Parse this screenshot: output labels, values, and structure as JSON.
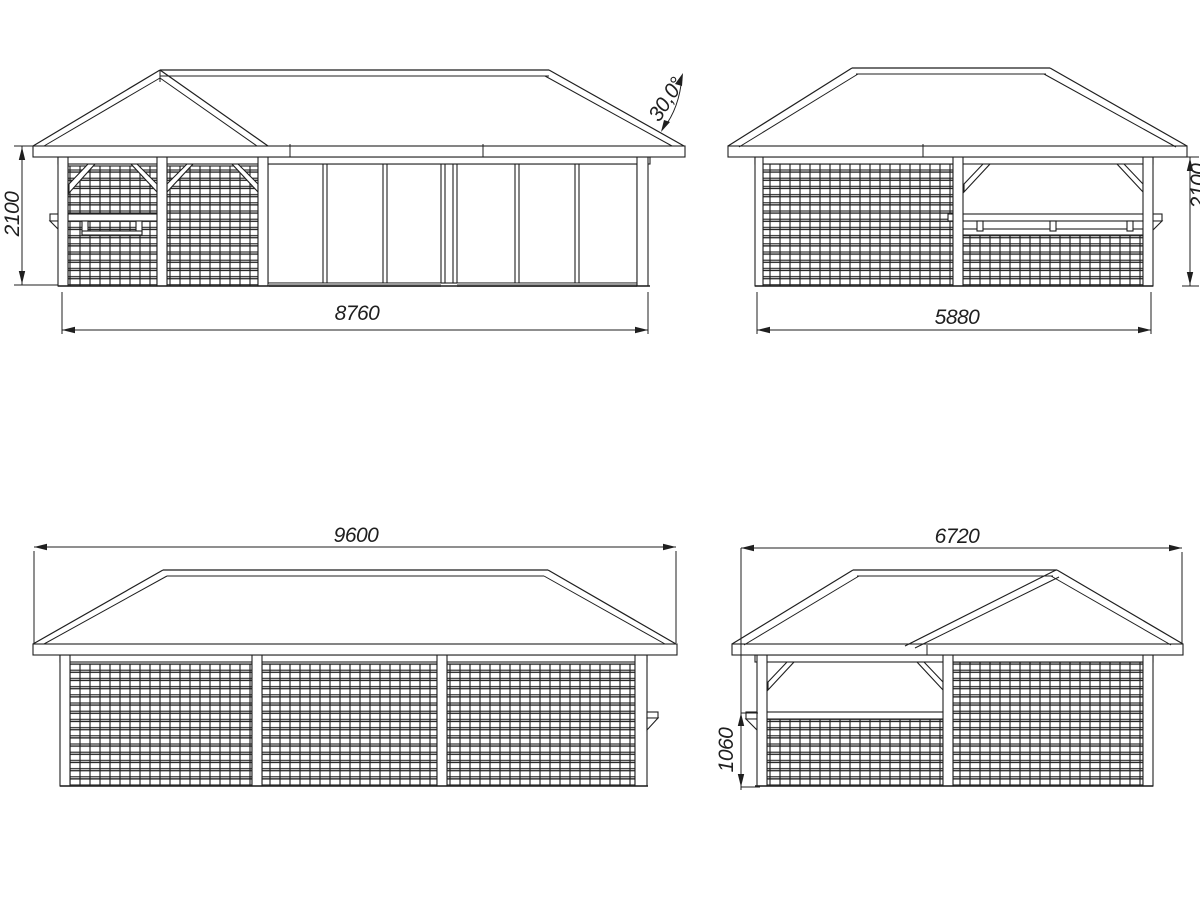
{
  "colors": {
    "line": "#1f1f1f",
    "background": "#ffffff",
    "glass_track": "#9a9a9a"
  },
  "front_elevation": {
    "wall_width": "8760",
    "wall_height": "2100",
    "roof_pitch": "30,0°"
  },
  "side_elevation_bar": {
    "wall_depth": "5880",
    "eave_height": "2100"
  },
  "rear_elevation": {
    "roof_width": "9600"
  },
  "side_elevation_gable": {
    "roof_depth": "6720",
    "counter_height": "1060"
  }
}
